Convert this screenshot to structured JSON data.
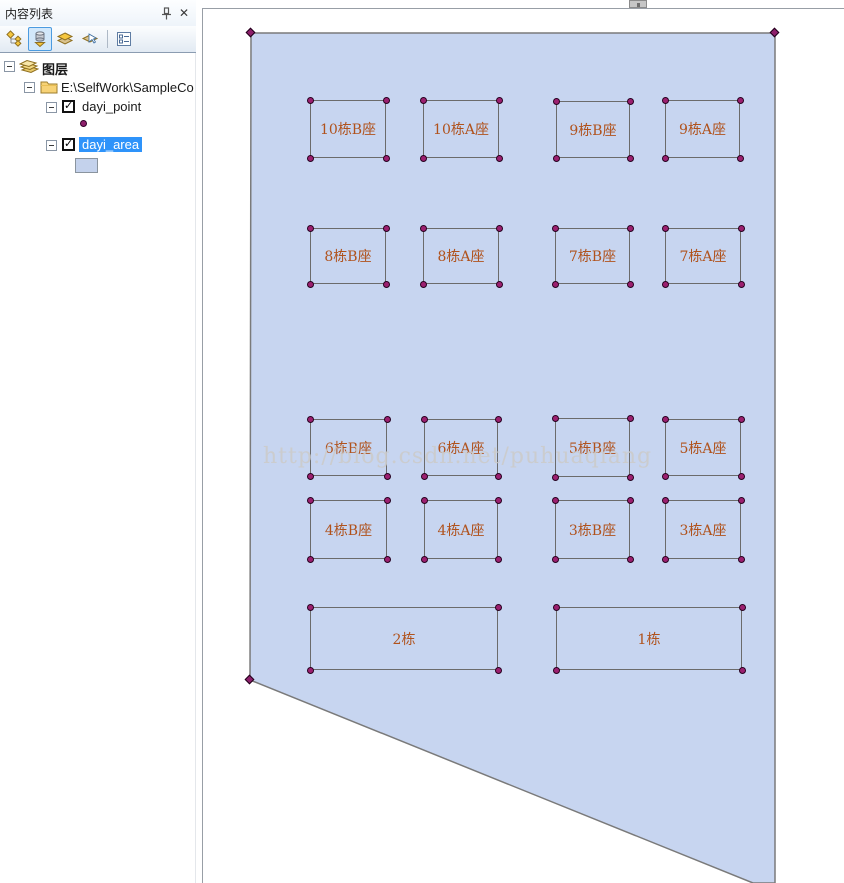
{
  "panel": {
    "title": "内容列表",
    "close_glyph": "✕",
    "toolbar": {
      "buttons": [
        {
          "name": "list-by-drawing-order"
        },
        {
          "name": "list-by-source",
          "active": true
        },
        {
          "name": "list-by-visibility"
        },
        {
          "name": "list-by-selection"
        },
        {
          "name": "options"
        }
      ]
    },
    "tree": {
      "layers_label": "图层",
      "folder_label": "E:\\SelfWork\\SampleCo",
      "point_layer": {
        "label": "dayi_point",
        "checked": true
      },
      "area_layer": {
        "label": "dayi_area",
        "checked": true,
        "selected": true
      }
    }
  },
  "map": {
    "watermark": "http://blog.csdn.net/puhuaqiang",
    "parcel": {
      "points": "251,33 775,33 775,883 753,883 250,680",
      "vertices": [
        [
          251,
          33
        ],
        [
          775,
          33
        ],
        [
          250,
          680
        ]
      ],
      "fill": "#c7d5f0",
      "stroke": "#7a7a7a"
    },
    "buildings": [
      {
        "label": "10栋B座",
        "x": 310,
        "y": 100,
        "w": 76,
        "h": 58
      },
      {
        "label": "10栋A座",
        "x": 423,
        "y": 100,
        "w": 76,
        "h": 58
      },
      {
        "label": "9栋B座",
        "x": 556,
        "y": 101,
        "w": 74,
        "h": 57
      },
      {
        "label": "9栋A座",
        "x": 665,
        "y": 100,
        "w": 75,
        "h": 58
      },
      {
        "label": "8栋B座",
        "x": 310,
        "y": 228,
        "w": 76,
        "h": 56
      },
      {
        "label": "8栋A座",
        "x": 423,
        "y": 228,
        "w": 76,
        "h": 56
      },
      {
        "label": "7栋B座",
        "x": 555,
        "y": 228,
        "w": 75,
        "h": 56
      },
      {
        "label": "7栋A座",
        "x": 665,
        "y": 228,
        "w": 76,
        "h": 56
      },
      {
        "label": "6栋B座",
        "x": 310,
        "y": 419,
        "w": 77,
        "h": 57
      },
      {
        "label": "6栋A座",
        "x": 424,
        "y": 419,
        "w": 74,
        "h": 57
      },
      {
        "label": "5栋B座",
        "x": 555,
        "y": 418,
        "w": 75,
        "h": 59
      },
      {
        "label": "5栋A座",
        "x": 665,
        "y": 419,
        "w": 76,
        "h": 57
      },
      {
        "label": "4栋B座",
        "x": 310,
        "y": 500,
        "w": 77,
        "h": 59
      },
      {
        "label": "4栋A座",
        "x": 424,
        "y": 500,
        "w": 74,
        "h": 59
      },
      {
        "label": "3栋B座",
        "x": 555,
        "y": 500,
        "w": 75,
        "h": 59
      },
      {
        "label": "3栋A座",
        "x": 665,
        "y": 500,
        "w": 76,
        "h": 59
      },
      {
        "label": "2栋",
        "x": 310,
        "y": 607,
        "w": 188,
        "h": 63
      },
      {
        "label": "1栋",
        "x": 556,
        "y": 607,
        "w": 186,
        "h": 63
      }
    ],
    "colors": {
      "building_label": "#b0521c",
      "vertex_fill": "#9c2070",
      "selection_bg": "#2e93fa"
    }
  }
}
